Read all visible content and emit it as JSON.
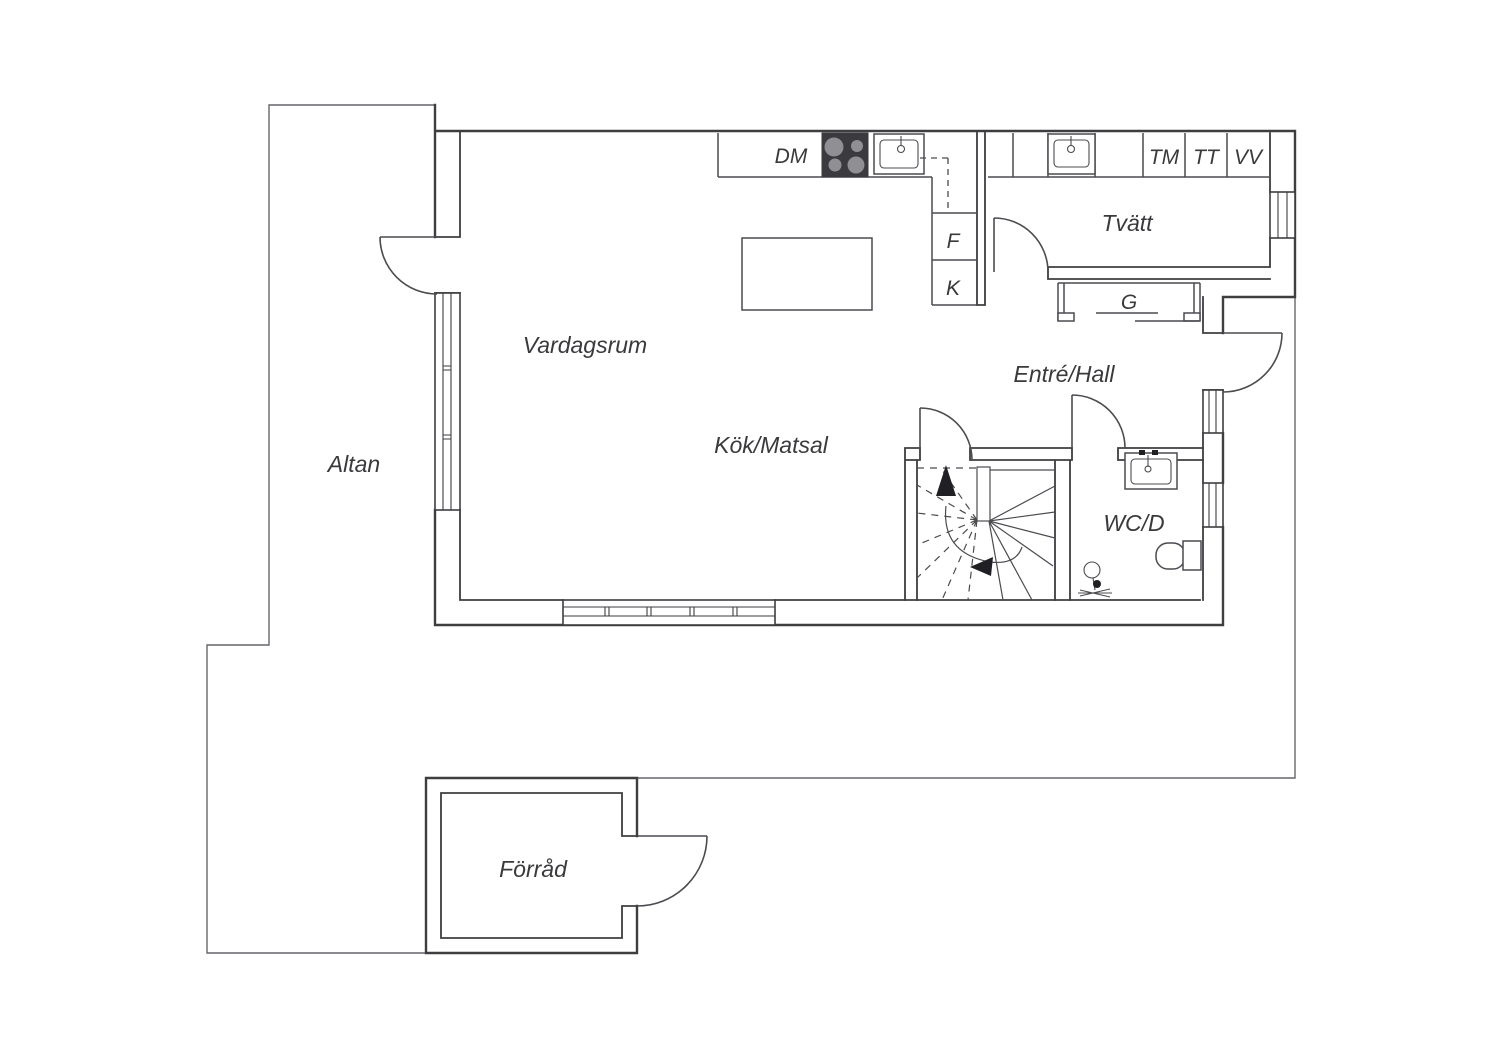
{
  "colors": {
    "wall": "#3e3e41",
    "thin": "#66666b",
    "fixline": "#4c4c50",
    "text": "#3a3a3d",
    "stove": "#3b3b3f",
    "burner": "#8f8f94",
    "arrow": "#202024",
    "bg": "#ffffff"
  },
  "rooms": {
    "altan": "Altan",
    "vardagsrum": "Vardagsrum",
    "kok_matsal": "Kök/Matsal",
    "entre_hall": "Entré/Hall",
    "tvatt": "Tvätt",
    "wc_d": "WC/D",
    "forrad": "Förråd"
  },
  "appliances": {
    "dm": "DM",
    "f": "F",
    "k": "K",
    "tm": "TM",
    "tt": "TT",
    "vv": "VV",
    "g": "G"
  }
}
